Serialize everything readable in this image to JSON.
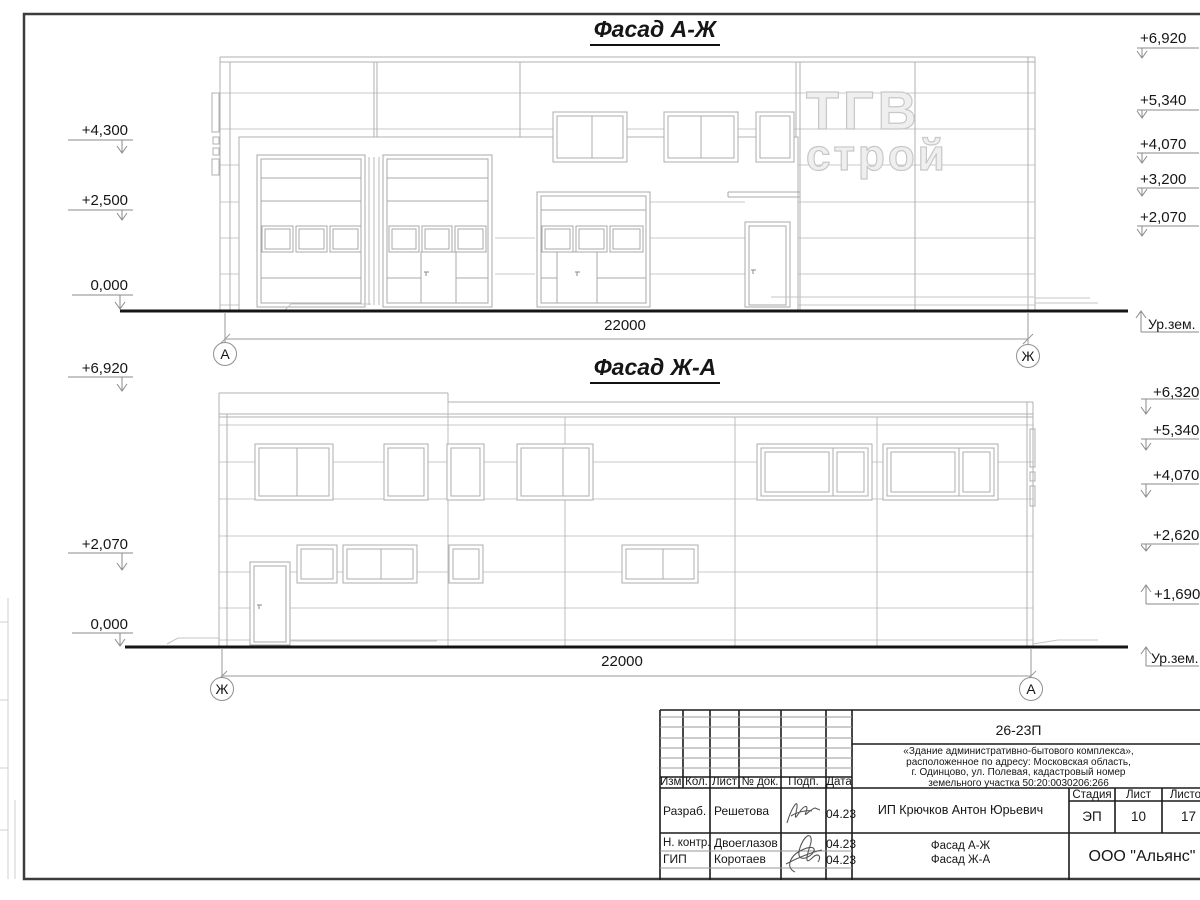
{
  "facade1": {
    "title": "Фасад А-Ж",
    "dim": "22000",
    "axis_left": "А",
    "axis_right": "Ж",
    "ground": "Ур.зем.",
    "left_marks": [
      "+4,300",
      "+2,500",
      "0,000"
    ],
    "right_marks": [
      "+6,920",
      "+5,340",
      "+4,070",
      "+3,200",
      "+2,070"
    ]
  },
  "facade2": {
    "title": "Фасад Ж-А",
    "dim": "22000",
    "axis_left": "Ж",
    "axis_right": "А",
    "ground": "Ур.зем.",
    "left_marks": [
      "+6,920",
      "+2,070",
      "0,000"
    ],
    "right_marks": [
      "+6,320",
      "+5,340",
      "+4,070",
      "+2,620",
      "+1,690"
    ]
  },
  "watermark": {
    "line1": "ТГВ",
    "line2": "строй"
  },
  "titleblock": {
    "doc_number": "26-23П",
    "description": [
      "«Здание административно-бытового комплекса»,",
      "расположенное по адресу: Московская область,",
      "г. Одинцово, ул. Полевая, кадастровый номер",
      "земельного участка 50:20:0030206:266"
    ],
    "table_headers": [
      "Изм.",
      "Кол.",
      "Лист",
      "№ док.",
      "Подп.",
      "Дата"
    ],
    "rows": [
      {
        "role": "Разраб.",
        "name": "Решетова",
        "date": "04.23"
      },
      {
        "role": "Н. контр.",
        "name": "Двоеглазов",
        "date": "04.23"
      },
      {
        "role": "ГИП",
        "name": "Коротаев",
        "date": "04.23"
      }
    ],
    "client": "ИП Крючков Антон Юрьевич",
    "stage_label": "Стадия",
    "sheet_label": "Лист",
    "sheets_label": "Листов",
    "stage": "ЭП",
    "sheet": "10",
    "sheets": "17",
    "drawing_title": [
      "Фасад А-Ж",
      "Фасад Ж-А"
    ],
    "company": "ООО \"Альянс\""
  }
}
